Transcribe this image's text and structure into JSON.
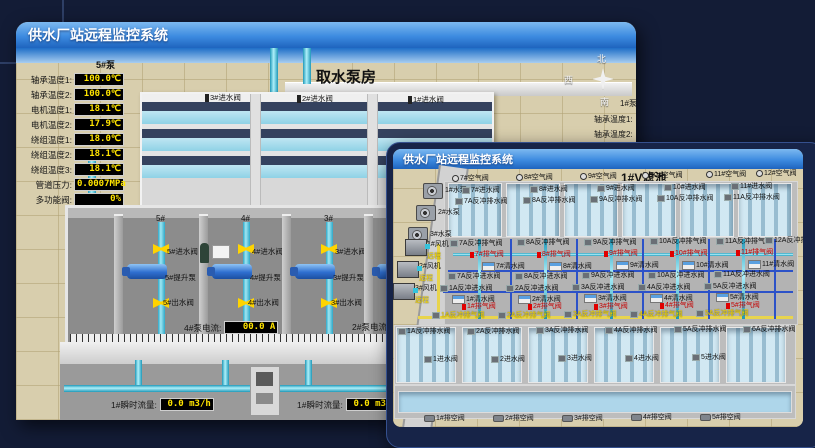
{
  "colors": {
    "background": "#131c36",
    "titlebar_top": "#7db9f0",
    "titlebar_bottom": "#1e64be",
    "ground_tan": "#d8cead",
    "sky_blue": "#4a8fd8",
    "water_blue": "#aed6ea",
    "pipe_cyan": "#35c3dc",
    "pipe_blue": "#2c52c8",
    "pipe_yellow": "#e8d44d",
    "value_text_yellow": "#ffe400",
    "alarm_red": "#e00000",
    "valve_yellow": "#ffd400"
  },
  "back_window": {
    "title_bar": {
      "title": "供水厂站远程监控系统"
    },
    "scene": {
      "title": "取水泵房",
      "pump_panel": {
        "header": "5#泵",
        "rows": [
          {
            "label": "轴承温度1:",
            "value": "100.0℃",
            "x": 10,
            "y": 25
          },
          {
            "label": "轴承温度2:",
            "value": "100.0℃",
            "x": 10,
            "y": 40
          },
          {
            "label": "电机温度1:",
            "value": "18.1℃",
            "x": 10,
            "y": 55
          },
          {
            "label": "电机温度2:",
            "value": "17.9℃",
            "x": 10,
            "y": 70
          },
          {
            "label": "绕组温度1:",
            "value": "18.0℃",
            "x": 10,
            "y": 85
          },
          {
            "label": "绕组温度2:",
            "value": "18.1℃",
            "x": 10,
            "y": 100
          },
          {
            "label": "绕组温度3:",
            "value": "18.1℃",
            "x": 10,
            "y": 115
          },
          {
            "label": "管道压力:",
            "value": "0.0007MPa",
            "x": 10,
            "y": 130
          },
          {
            "label": "多功能阀:",
            "value": "0%",
            "x": 10,
            "y": 145
          }
        ]
      },
      "basin_valves": [
        {
          "t": "3#进水阀",
          "x": 189,
          "y": 46
        },
        {
          "t": "2#进水阀",
          "x": 281,
          "y": 47
        },
        {
          "t": "1#进水阀",
          "x": 392,
          "y": 48
        }
      ],
      "compass": {
        "north": "北",
        "west": "西",
        "south": "南"
      },
      "side_labels": [
        {
          "t": "1#泵",
          "x": 604,
          "y": 50
        },
        {
          "t": "轴承温度1:",
          "x": 578,
          "y": 66
        },
        {
          "t": "轴承温度2:",
          "x": 578,
          "y": 81
        }
      ],
      "bays": [
        {
          "header": "5#",
          "inlet_valve": "5#进水阀",
          "pump": "5#提升泵",
          "outlet_valve": "5#出水阀",
          "x": 102
        },
        {
          "header": "4#",
          "inlet_valve": "4#进水阀",
          "pump": "4#提升泵",
          "outlet_valve": "4#出水阀",
          "x": 187
        },
        {
          "header": "3#",
          "inlet_valve": "3#进水阀",
          "pump": "3#提升泵",
          "outlet_valve": "3#出水阀",
          "x": 270
        },
        {
          "header": "2#",
          "inlet_valve": "2#进水阀",
          "pump": "2#提升泵",
          "outlet_valve": "2#出水阀",
          "x": 352
        }
      ],
      "current_readouts": [
        {
          "label": "4#泵电流:",
          "value": "00.0 A",
          "x": 168,
          "y": 273
        },
        {
          "label": "2#泵电流:",
          "value": "",
          "x": 336,
          "y": 273
        }
      ],
      "flow_readouts": [
        {
          "label": "1#瞬时流量:",
          "value": "0.0 m3/h",
          "x": 95,
          "y": 350
        },
        {
          "label": "1#瞬时流量:",
          "value": "0.0 m3/h",
          "x": 281,
          "y": 350
        }
      ]
    }
  },
  "front_window": {
    "title_bar": {
      "title": "供水厂站远程监控系统"
    },
    "scene": {
      "title": "1#V滤池",
      "pumps": [
        {
          "t": "1#水泵",
          "x": 30,
          "y": 14
        },
        {
          "t": "2#水泵",
          "x": 23,
          "y": 36
        },
        {
          "t": "3#水泵",
          "x": 15,
          "y": 58
        }
      ],
      "blowers": [
        {
          "t": "1#风机",
          "s": "远程",
          "x": 12,
          "y": 70
        },
        {
          "t": "2#风机",
          "s": "远程",
          "x": 4,
          "y": 92
        },
        {
          "t": "3#风机",
          "s": "远程",
          "x": 0,
          "y": 114
        }
      ],
      "air_top": [
        {
          "t": "7#空气阀",
          "x": 59,
          "y": 6
        },
        {
          "t": "8#空气阀",
          "x": 123,
          "y": 5
        },
        {
          "t": "9#空气阀",
          "x": 187,
          "y": 4
        },
        {
          "t": "10#空气阀",
          "x": 249,
          "y": 3
        },
        {
          "t": "11#空气阀",
          "x": 313,
          "y": 2
        },
        {
          "t": "12#空气阀",
          "x": 363,
          "y": 1
        }
      ],
      "inlet_top": [
        {
          "t": "7#进水阀",
          "x": 69,
          "y": 18
        },
        {
          "t": "8#进水阀",
          "x": 137,
          "y": 17
        },
        {
          "t": "9#进水阀",
          "x": 204,
          "y": 16
        },
        {
          "t": "10#进水阀",
          "x": 271,
          "y": 15
        },
        {
          "t": "11#进水阀",
          "x": 338,
          "y": 14
        }
      ],
      "bw_drain_top": [
        {
          "t": "7A反冲排水阀",
          "x": 62,
          "y": 29
        },
        {
          "t": "8A反冲排水阀",
          "x": 130,
          "y": 28
        },
        {
          "t": "9A反冲排水阀",
          "x": 197,
          "y": 27
        },
        {
          "t": "10A反冲排水阀",
          "x": 264,
          "y": 26
        },
        {
          "t": "11A反冲排水阀",
          "x": 331,
          "y": 25
        }
      ],
      "bw_air_top": [
        {
          "t": "7A反冲排气阀",
          "x": 57,
          "y": 71
        },
        {
          "t": "8A反冲排气阀",
          "x": 124,
          "y": 70
        },
        {
          "t": "9A反冲排气阀",
          "x": 191,
          "y": 70
        },
        {
          "t": "10A反冲排气阀",
          "x": 257,
          "y": 69
        },
        {
          "t": "11A反冲排气阀",
          "x": 323,
          "y": 69
        },
        {
          "t": "12A反冲排气阀",
          "x": 372,
          "y": 68
        }
      ],
      "vent_top": [
        {
          "t": "7#排气阀",
          "x": 77,
          "y": 82
        },
        {
          "t": "8#排气阀",
          "x": 144,
          "y": 82
        },
        {
          "t": "9#排气阀",
          "x": 211,
          "y": 81
        },
        {
          "t": "10#排气阀",
          "x": 277,
          "y": 81
        },
        {
          "t": "11#排气阀",
          "x": 343,
          "y": 80
        }
      ],
      "clean_top": [
        {
          "t": "7#清水阀",
          "x": 89,
          "y": 93
        },
        {
          "t": "8#清水阀",
          "x": 156,
          "y": 93
        },
        {
          "t": "9#清水阀",
          "x": 223,
          "y": 92
        },
        {
          "t": "10#清水阀",
          "x": 289,
          "y": 92
        },
        {
          "t": "11#清水阀",
          "x": 355,
          "y": 91
        }
      ],
      "bw_inlet_top": [
        {
          "t": "7A反冲进水阀",
          "x": 55,
          "y": 104
        },
        {
          "t": "8A反冲进水阀",
          "x": 122,
          "y": 104
        },
        {
          "t": "9A反冲进水阀",
          "x": 189,
          "y": 103
        },
        {
          "t": "10A反冲进水阀",
          "x": 255,
          "y": 103
        },
        {
          "t": "11A反冲进水阀",
          "x": 321,
          "y": 102
        }
      ],
      "bw_inlet_bottom": [
        {
          "t": "1A反冲进水阀",
          "x": 47,
          "y": 116
        },
        {
          "t": "2A反冲进水阀",
          "x": 113,
          "y": 116
        },
        {
          "t": "3A反冲进水阀",
          "x": 179,
          "y": 115
        },
        {
          "t": "4A反冲进水阀",
          "x": 245,
          "y": 115
        },
        {
          "t": "5A反冲进水阀",
          "x": 311,
          "y": 114
        }
      ],
      "clean_bottom": [
        {
          "t": "1#清水阀",
          "x": 59,
          "y": 126
        },
        {
          "t": "2#清水阀",
          "x": 125,
          "y": 126
        },
        {
          "t": "3#清水阀",
          "x": 191,
          "y": 125
        },
        {
          "t": "4#清水阀",
          "x": 257,
          "y": 125
        },
        {
          "t": "5#清水阀",
          "x": 323,
          "y": 124
        }
      ],
      "vent_bottom": [
        {
          "t": "1#排气阀",
          "x": 69,
          "y": 134
        },
        {
          "t": "2#排气阀",
          "x": 135,
          "y": 134
        },
        {
          "t": "3#排气阀",
          "x": 201,
          "y": 134
        },
        {
          "t": "4#排气阀",
          "x": 267,
          "y": 133
        },
        {
          "t": "5#排气阀",
          "x": 333,
          "y": 133
        }
      ],
      "bw_air_bottom": [
        {
          "t": "1A反冲排气阀",
          "x": 39,
          "y": 143
        },
        {
          "t": "2A反冲排气阀",
          "x": 105,
          "y": 143
        },
        {
          "t": "3A反冲排气阀",
          "x": 171,
          "y": 142
        },
        {
          "t": "4A反冲排气阀",
          "x": 237,
          "y": 142
        },
        {
          "t": "5A反冲排气阀",
          "x": 303,
          "y": 141
        }
      ],
      "bw_drain_bottom": [
        {
          "t": "1A反冲排水阀",
          "x": 5,
          "y": 159
        },
        {
          "t": "2A反冲排水阀",
          "x": 74,
          "y": 159
        },
        {
          "t": "3A反冲排水阀",
          "x": 143,
          "y": 158
        },
        {
          "t": "4A反冲排水阀",
          "x": 212,
          "y": 158
        },
        {
          "t": "5A反冲排水阀",
          "x": 281,
          "y": 157
        },
        {
          "t": "6A反冲排水阀",
          "x": 350,
          "y": 157
        }
      ],
      "inlet_bottom": [
        {
          "t": "1进水阀",
          "x": 31,
          "y": 187
        },
        {
          "t": "2进水阀",
          "x": 98,
          "y": 187
        },
        {
          "t": "3进水阀",
          "x": 165,
          "y": 186
        },
        {
          "t": "4进水阀",
          "x": 232,
          "y": 186
        },
        {
          "t": "5进水阀",
          "x": 299,
          "y": 185
        }
      ],
      "drain_bottom": [
        {
          "t": "1#排空阀",
          "x": 31,
          "y": 246
        },
        {
          "t": "2#排空阀",
          "x": 100,
          "y": 246
        },
        {
          "t": "3#排空阀",
          "x": 169,
          "y": 246
        },
        {
          "t": "4#排空阀",
          "x": 238,
          "y": 245
        },
        {
          "t": "5#排空阀",
          "x": 307,
          "y": 245
        }
      ]
    }
  }
}
